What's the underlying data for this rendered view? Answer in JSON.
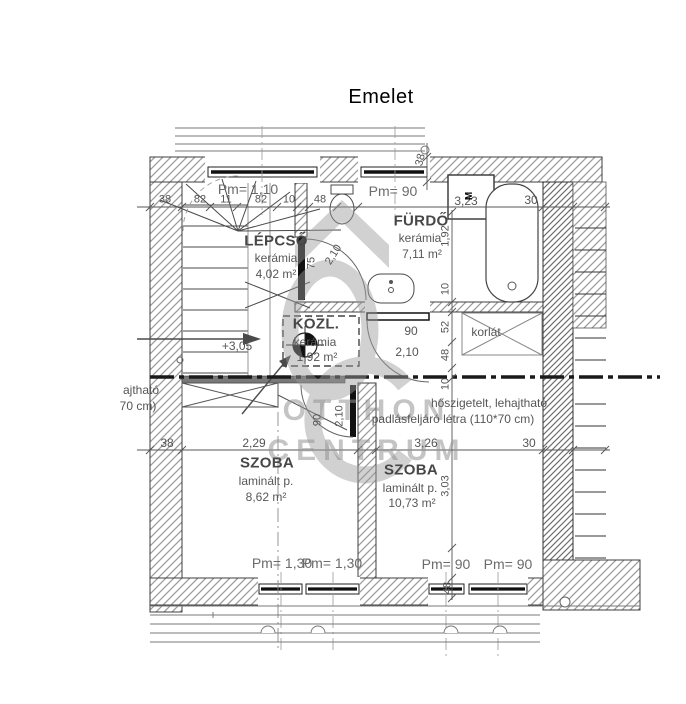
{
  "title": "Emelet",
  "rooms": {
    "lepcso": {
      "name": "LÉPCSŐ",
      "floor": "kerámia",
      "area": "4,02 m²"
    },
    "furdo": {
      "name": "FÜRDŐ",
      "floor": "kerámia",
      "area": "7,11 m²"
    },
    "kozl": {
      "name": "KÖZL.",
      "floor": "kerámia",
      "area": "1,92 m²"
    },
    "szoba_left": {
      "name": "SZOBA",
      "floor": "laminált p.",
      "area": "8,62 m²"
    },
    "szoba_right": {
      "name": "SZOBA",
      "floor": "laminált p.",
      "area": "10,73 m²"
    }
  },
  "parapets": {
    "stairs": "Pm= 1,10",
    "bath": "Pm= 90",
    "szoba_left_w1": "Pm= 1,30",
    "szoba_left_w2": "Pm= 1,30",
    "szoba_right_w1": "Pm= 90",
    "szoba_right_w2": "Pm= 90"
  },
  "dims": {
    "top_chain": [
      "38",
      "82",
      "11",
      "82",
      "10",
      "48"
    ],
    "bath_width": "3,23",
    "wall_top_right": "30",
    "wall_top_thickness": "38",
    "bath_depth": "1,92",
    "right_chain": [
      "10",
      "52",
      "48",
      "10"
    ],
    "door_bath_w": "75",
    "door_bath_h": "2,10",
    "door_hall_w": "90",
    "door_hall_h": "2,10",
    "door_room_w": "90",
    "door_room_h": "2,10",
    "level": "+3,05",
    "room_left_width": "2,29",
    "wall_left_thickness": "38",
    "room_right_width": "3,26",
    "wall_right_thickness": "30",
    "room_right_depth": "3,03",
    "sill_detail": "48"
  },
  "annotations": {
    "railing": "korlát",
    "attic_line1": "hőszigetelt, lehajtható",
    "attic_line2": "padlásfeljáró létra (110*70 cm)",
    "door_note_line1": "ajtható",
    "door_note_line2": "70 cm)",
    "washer": "M"
  },
  "watermark": {
    "line1": "OTTHON",
    "line2": "CENTRUM"
  }
}
